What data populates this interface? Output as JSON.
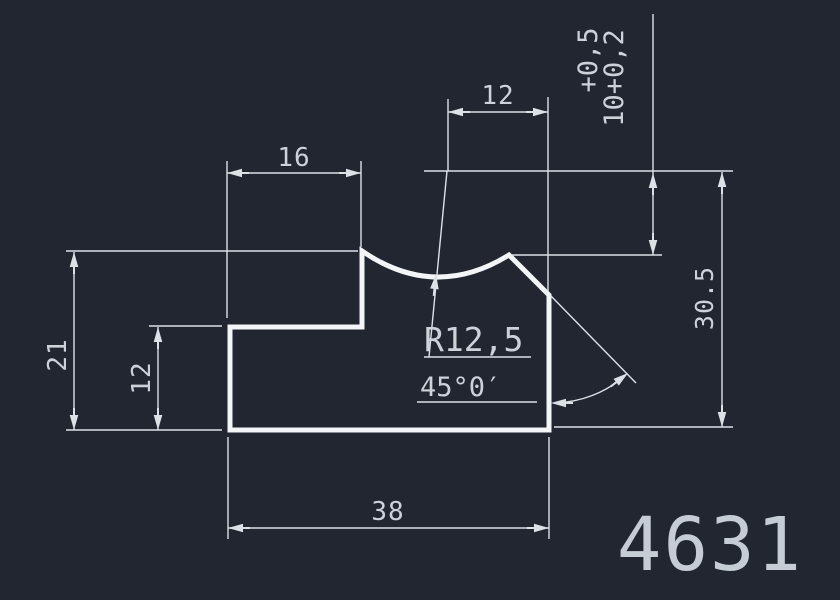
{
  "colors": {
    "bg": "#212631",
    "outline": "#f3f5f7",
    "dim-line": "#dce1e5",
    "dim-text": "#ccd2d8",
    "part-number": "#c6ccd3"
  },
  "dimensions": {
    "top_width": "16",
    "upper_notch_width": "12",
    "left_height": "21",
    "left_step_height": "12",
    "bottom_width": "38",
    "right_height": "30.5",
    "tolerance_upper_line": "+0,5",
    "tolerance_lower_line": "10+0,2",
    "radius": "R12,5",
    "angle": "45°0′"
  },
  "part_number": "4631"
}
